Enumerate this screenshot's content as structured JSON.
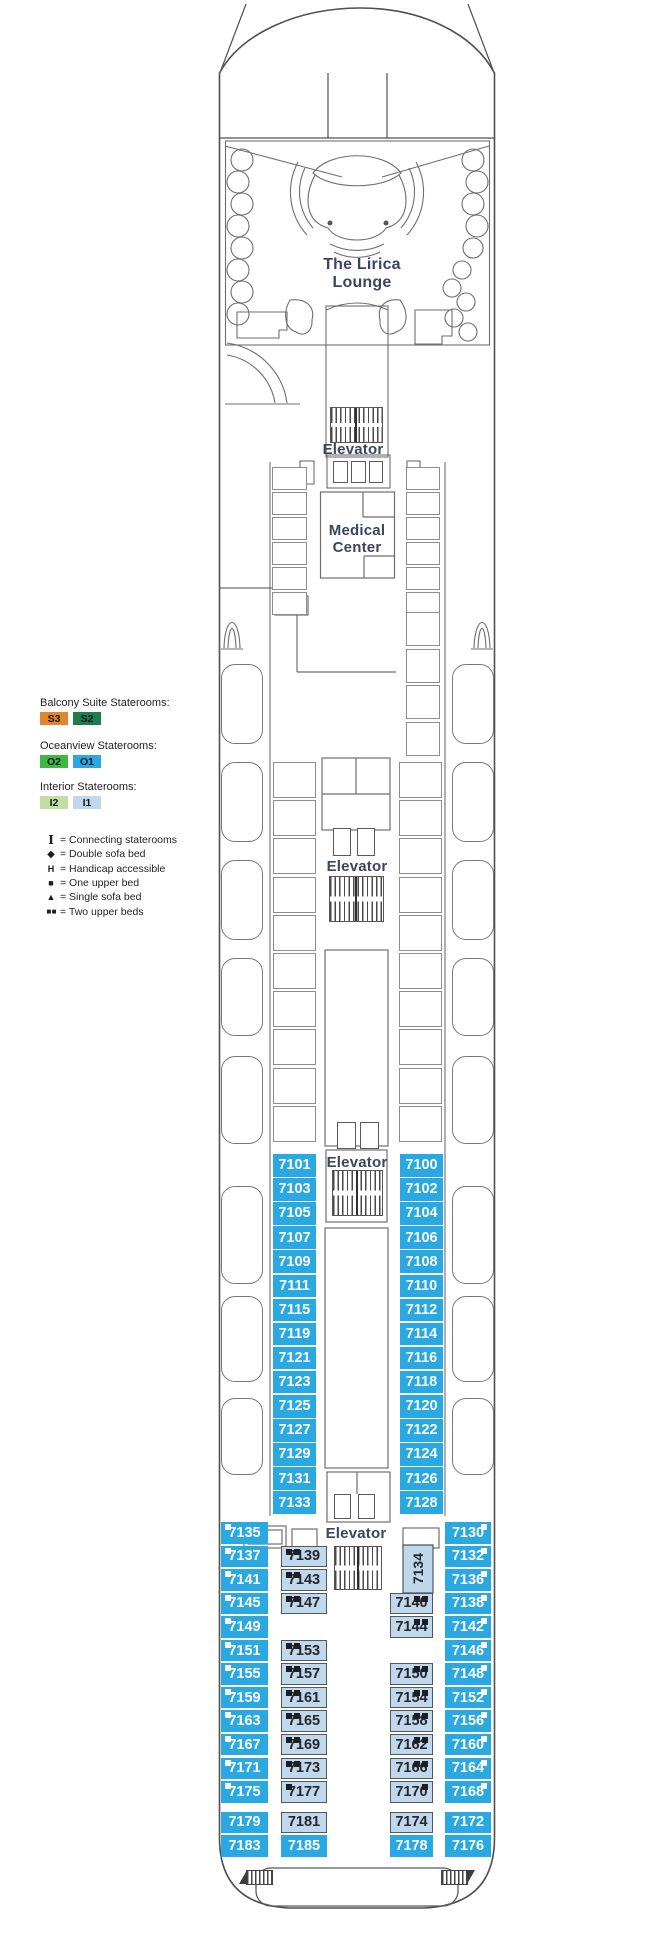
{
  "colors": {
    "oceanview": "#29A8E1",
    "interior": "#BFD8EC",
    "suite_s3": "#E2862B",
    "suite_s2": "#207B4F",
    "oceanview_o2": "#3DB944",
    "interior_i2": "#C4DDA2",
    "label_text": "#3B4560",
    "cabin_dark_text": "#26262C"
  },
  "labels": {
    "lounge_1": "The Lirica",
    "lounge_2": "Lounge",
    "elevator": "Elevator",
    "medical_1": "Medical",
    "medical_2": "Center"
  },
  "legend": {
    "categories": [
      {
        "title": "Balcony Suite Staterooms:",
        "chips": [
          {
            "code": "S3",
            "color": "#E2862B"
          },
          {
            "code": "S2",
            "color": "#207B4F"
          }
        ]
      },
      {
        "title": "Oceanview Staterooms:",
        "chips": [
          {
            "code": "O2",
            "color": "#3DB944"
          },
          {
            "code": "O1",
            "color": "#29A8E1"
          }
        ]
      },
      {
        "title": "Interior Staterooms:",
        "chips": [
          {
            "code": "I2",
            "color": "#C4DDA2"
          },
          {
            "code": "I1",
            "color": "#BFD8EC"
          }
        ]
      }
    ],
    "symbols": [
      {
        "glyph": "I",
        "label": "= Connecting staterooms"
      },
      {
        "glyph": "◆",
        "label": "= Double sofa bed"
      },
      {
        "glyph": "H",
        "label": "= Handicap accessible"
      },
      {
        "glyph": "■",
        "label": "= One upper bed"
      },
      {
        "glyph": "▲",
        "label": "= Single sofa bed"
      },
      {
        "glyph": "■ ■",
        "label": "= Two upper beds"
      }
    ]
  },
  "cabins": {
    "upper_left": [
      "7101",
      "7103",
      "7105",
      "7107",
      "7109",
      "7111",
      "7115",
      "7119",
      "7121",
      "7123",
      "7125",
      "7127",
      "7129",
      "7131",
      "7133"
    ],
    "upper_right": [
      "7100",
      "7102",
      "7104",
      "7106",
      "7108",
      "7110",
      "7112",
      "7114",
      "7116",
      "7118",
      "7120",
      "7122",
      "7124",
      "7126",
      "7128"
    ],
    "lower_outer_left": [
      {
        "n": "7135",
        "row": 0,
        "bed": "one"
      },
      {
        "n": "7137",
        "row": 1,
        "bed": "one"
      },
      {
        "n": "7141",
        "row": 2,
        "bed": "one"
      },
      {
        "n": "7145",
        "row": 3,
        "bed": "one"
      },
      {
        "n": "7149",
        "row": 4,
        "bed": "one"
      },
      {
        "n": "7151",
        "row": 5,
        "bed": "one"
      },
      {
        "n": "7155",
        "row": 6,
        "bed": "one"
      },
      {
        "n": "7159",
        "row": 7,
        "bed": "one"
      },
      {
        "n": "7163",
        "row": 8,
        "bed": "one"
      },
      {
        "n": "7167",
        "row": 9,
        "bed": "one"
      },
      {
        "n": "7171",
        "row": 10,
        "bed": "one"
      },
      {
        "n": "7175",
        "row": 11,
        "bed": "one"
      },
      {
        "n": "7179",
        "row": 12
      },
      {
        "n": "7183",
        "row": 13
      }
    ],
    "lower_inner_left": [
      {
        "n": "7139",
        "row": 1,
        "bed": "two"
      },
      {
        "n": "7143",
        "row": 2,
        "bed": "two"
      },
      {
        "n": "7147",
        "row": 3,
        "bed": "two"
      },
      {
        "n": "7153",
        "row": 5,
        "bed": "two"
      },
      {
        "n": "7157",
        "row": 6,
        "bed": "two"
      },
      {
        "n": "7161",
        "row": 7,
        "bed": "two"
      },
      {
        "n": "7165",
        "row": 8,
        "bed": "two"
      },
      {
        "n": "7169",
        "row": 9,
        "bed": "two"
      },
      {
        "n": "7173",
        "row": 10,
        "bed": "two"
      },
      {
        "n": "7177",
        "row": 11,
        "bed": "one"
      },
      {
        "n": "7181",
        "row": 12
      },
      {
        "n": "7185",
        "row": 13,
        "c": "blue"
      }
    ],
    "lower_inner_right": [
      {
        "n": "7134",
        "row": 1,
        "span": 2,
        "rot": true
      },
      {
        "n": "7140",
        "row": 3,
        "bed": "two"
      },
      {
        "n": "7144",
        "row": 4,
        "bed": "two"
      },
      {
        "n": "7150",
        "row": 6,
        "bed": "two"
      },
      {
        "n": "7154",
        "row": 7,
        "bed": "two"
      },
      {
        "n": "7158",
        "row": 8,
        "bed": "two"
      },
      {
        "n": "7162",
        "row": 9,
        "bed": "two"
      },
      {
        "n": "7166",
        "row": 10,
        "bed": "two"
      },
      {
        "n": "7170",
        "row": 11,
        "bed": "one"
      },
      {
        "n": "7174",
        "row": 12
      },
      {
        "n": "7178",
        "row": 13,
        "c": "blue"
      }
    ],
    "lower_outer_right": [
      {
        "n": "7130",
        "row": 0,
        "bed": "one"
      },
      {
        "n": "7132",
        "row": 1,
        "bed": "one"
      },
      {
        "n": "7136",
        "row": 2,
        "bed": "one"
      },
      {
        "n": "7138",
        "row": 3,
        "bed": "one"
      },
      {
        "n": "7142",
        "row": 4,
        "bed": "one"
      },
      {
        "n": "7146",
        "row": 5,
        "bed": "one"
      },
      {
        "n": "7148",
        "row": 6,
        "bed": "one"
      },
      {
        "n": "7152",
        "row": 7,
        "bed": "one"
      },
      {
        "n": "7156",
        "row": 8,
        "bed": "one"
      },
      {
        "n": "7160",
        "row": 9,
        "bed": "one"
      },
      {
        "n": "7164",
        "row": 10,
        "bed": "one"
      },
      {
        "n": "7168",
        "row": 11,
        "bed": "one"
      },
      {
        "n": "7172",
        "row": 12
      },
      {
        "n": "7176",
        "row": 13
      }
    ]
  }
}
